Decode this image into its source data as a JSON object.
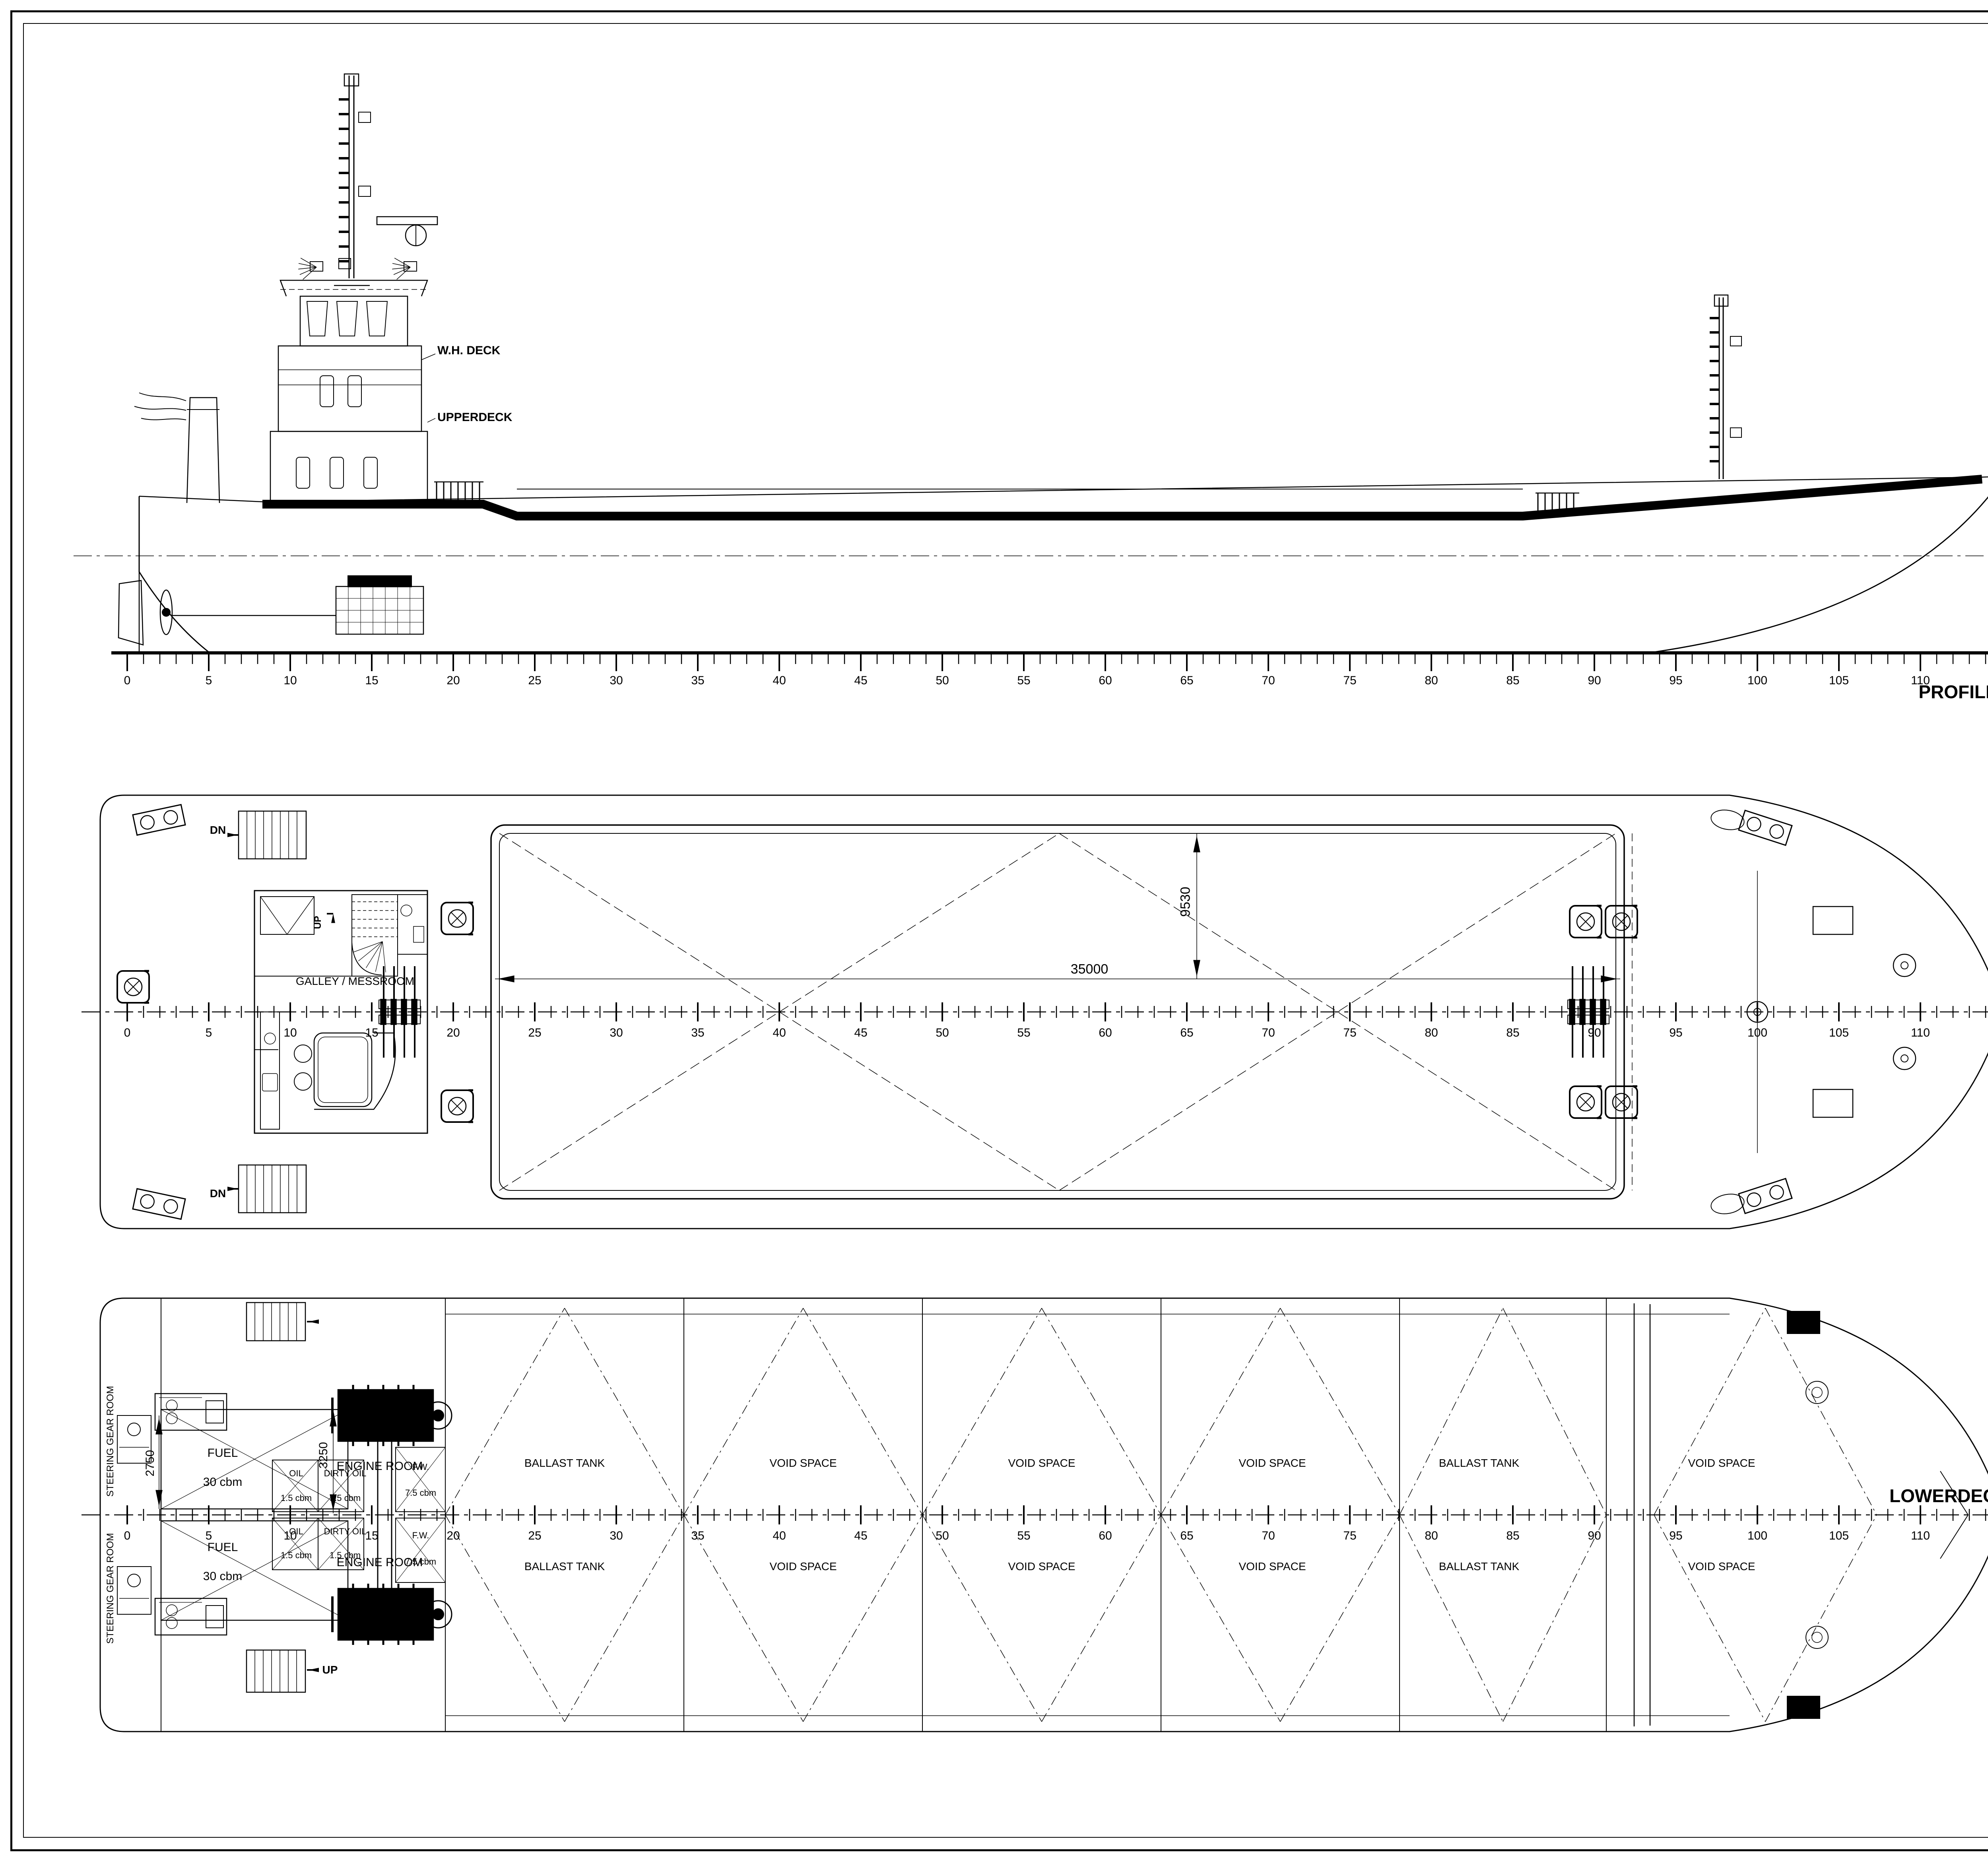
{
  "sheet_title": "1000 m³ SPLIT BARGE General Arrangement drawing",
  "frame_ruler": {
    "major_labels": [
      "0",
      "5",
      "10",
      "15",
      "20",
      "25",
      "30",
      "35",
      "40",
      "45",
      "50",
      "55",
      "60",
      "65",
      "70",
      "75",
      "80",
      "85",
      "90",
      "95",
      "100",
      "105",
      "110",
      "115"
    ]
  },
  "profile": {
    "title": "PROFILE",
    "wh_deck": "W.H. DECK",
    "upperdeck": "UPPERDECK",
    "bl": "BL"
  },
  "section": {
    "bl": "BL",
    "cl": "CL",
    "width": "13330",
    "depth": "4440",
    "coaming": "1150"
  },
  "upperdeck_plan": {
    "title": "UPPERDECK",
    "cabin": "2 CREW",
    "dn": "DN",
    "up": "UP"
  },
  "whdeck_plan": {
    "title": "W.H. DECK",
    "room": "WHEELHOUSE",
    "dn": "DN"
  },
  "maindeck": {
    "label": "MAINDECK",
    "galley": "GALLEY / MESSROOM",
    "hopper_length": "35000",
    "hopper_width": "9530",
    "dn": "DN",
    "up": "UP"
  },
  "lowerdeck": {
    "label": "LOWERDECK",
    "compartments": [
      "BALLAST TANK",
      "VOID SPACE",
      "VOID SPACE",
      "VOID SPACE",
      "BALLAST TANK",
      "VOID SPACE"
    ],
    "steering_gear": "STEERING GEAR ROOM",
    "engine_room": "ENGINE ROOM",
    "fuel": "FUEL",
    "fuel_vol": "30 cbm",
    "oil": "OIL",
    "oil_vol": "1.5 cbm",
    "dirty_oil": "DIRTY OIL",
    "dirty_oil_vol": "1.5 cbm",
    "fw": "F.W.",
    "fw_vol": "7.5 cbm",
    "dim_aft_tank": "2750",
    "dim_er": "3250",
    "up": "UP"
  },
  "main_dimensions": {
    "title": "Main Dimensions:",
    "rows": [
      {
        "label": "Hull Length",
        "value": "60,00 m"
      },
      {
        "label": "Length with append.",
        "value": "60,7 m"
      },
      {
        "label": "Waterline Length",
        "value": "58,83 m"
      },
      {
        "label": "Width",
        "value": "13,33 m"
      },
      {
        "label": "Maximum Width",
        "value": "14,13 m"
      },
      {
        "label": "Height",
        "value": "4,44 m"
      },
      {
        "label": "Draft",
        "value": "3,90 m"
      },
      {
        "label": "Speed",
        "value": "13,0 kn"
      },
      {
        "label": "Main Engine",
        "value": "2x abt.1500"
      }
    ],
    "hopper_title": "Hopper Capacity",
    "hopper_rows": [
      {
        "label": "Volume",
        "value": "Abt 1000cum"
      },
      {
        "label": "Length",
        "value": "35 m"
      },
      {
        "label": "Width",
        "value": "9.53 m"
      }
    ],
    "crew_label": "Crew",
    "crew_value": "8 Person"
  },
  "title_block": {
    "company": "ENDAZE",
    "tagline1": "DESIGN",
    "tagline2": "ENGINEERING",
    "tagline3": "CONSULTING",
    "address1": "Guzelyali Mah. Kunye Sok. No:3 K:3",
    "address2": "Tel:+90-216-493 59 74 - Fax:+90-216-493 59 76",
    "address3": "Pendik-ISTANBUL / TURKIYE",
    "address4": "endaze@endaze.com",
    "project_title": "1000 m³ SPLIT BARGE",
    "drawing_title": "GENERAL ARRANGEMENT",
    "designed_by_label": "DESIGNED BY",
    "designed_by": "YAVUZ ER",
    "drawn_by_label": "DRAWN BY",
    "drawn_by": "E.M.E.",
    "checked_by_label": "CHECKED BY",
    "checked_by": "YAVUZ ER",
    "owner_label": "OWNER",
    "owner": "-",
    "shipyard_label": "SHIPYARD",
    "shipyard": "-",
    "hull_nr_label": "HULL NR",
    "hull_nr": "-",
    "drawing_no_label": "DRAWING NO",
    "drawing_no": "EP91",
    "sheet_label": "SHEET",
    "sheet": "1/1",
    "scale_label": "SCALE",
    "scale1": "A1",
    "scale2": "1/100",
    "date_label": "DATE",
    "date": "07.06.2011",
    "class_label": "CLASS",
    "class": "LRS",
    "disclaimer": "This document is property of  Endaze Marine Engineering Ltd. and cannot be copied, modified in whole or in part without written permission."
  }
}
